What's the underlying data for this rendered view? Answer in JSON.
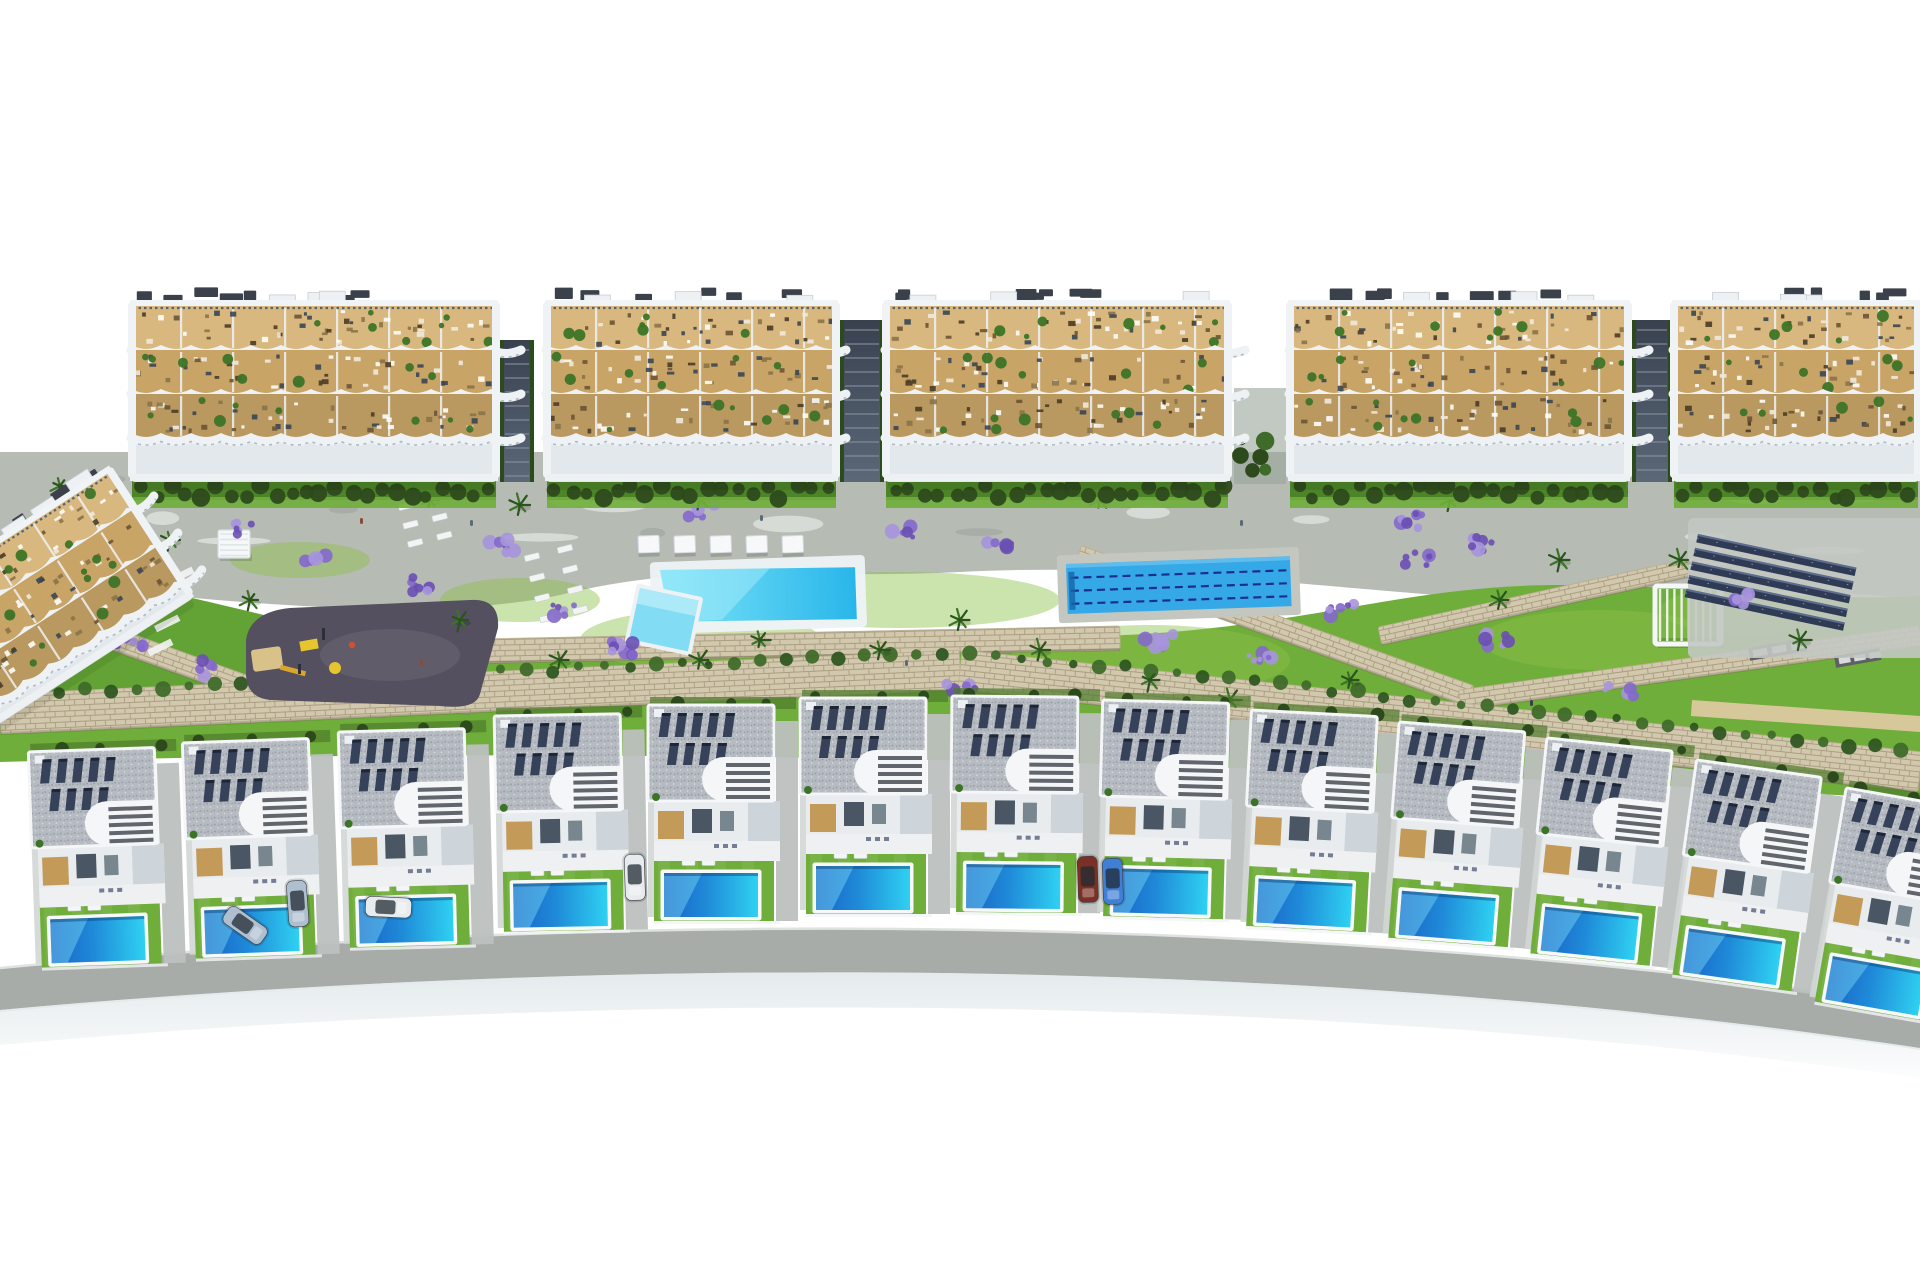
{
  "scene": {
    "description": "aerial-3d-render-residential-resort-complex",
    "canvas": {
      "w": 1920,
      "h": 1280,
      "background": "#ffffff"
    },
    "palette": {
      "white": "#ffffff",
      "concrete": "#b6bbb3",
      "concrete_light": "#e9ece8",
      "path_dark": "#9aa09b",
      "grass": "#6fae3a",
      "grass_light": "#8cc04a",
      "grass_dark": "#4e8f2d",
      "hedge": "#2d4a1c",
      "hedge_mid": "#4c8427",
      "stone": "#d2c8ae",
      "stone_joint": "#ab9e81",
      "lavender": "#8468cc",
      "lavender_light": "#a795dd",
      "lavender_dark": "#6a4fb4",
      "palm": "#3c7427",
      "palm_dark": "#29541b",
      "terrace_tan": "#c9a467",
      "terrace_sand": "#d8b87e",
      "balcony_white": "#eef2f5",
      "railing": "#59636f",
      "roof_unit": "#3a414a",
      "pool_main_1": "#7ce4f8",
      "pool_main_2": "#29b6ea",
      "pool_small": "#82dcf4",
      "lap_pool": "#35a9e8",
      "lane": "#1c2f8e",
      "playground": "#54505f",
      "play_yellow": "#e6c52f",
      "sand": "#d9c28a",
      "solar": "#2f3b55",
      "solar_edge": "#5d6d8e",
      "villa_roof": "#b6bac1",
      "villa_roof_dot": "#949aa5",
      "villa_white": "#f4f6f8",
      "villa_wall_shade": "#cdd5da",
      "wood": "#c49a58",
      "window_dark": "#3a4654",
      "stair": "#474c55",
      "villa_pool_1": "#1a63c8",
      "villa_pool_2": "#2fd1f2",
      "driveway": "#bcc0be",
      "road": "#a7aca8",
      "road_shadow": "#c6d2d8",
      "car_silver": "#aebfd0",
      "car_white": "#e8ebee",
      "car_blue": "#3f7fd6",
      "car_maroon": "#7a3024"
    },
    "apartment_blocks": [
      {
        "x": 130,
        "y": 292,
        "w": 368,
        "h": 190
      },
      {
        "x": 545,
        "y": 292,
        "w": 293,
        "h": 190
      },
      {
        "x": 884,
        "y": 292,
        "w": 346,
        "h": 190
      },
      {
        "x": 1288,
        "y": 292,
        "w": 342,
        "h": 190
      },
      {
        "x": 1672,
        "y": 292,
        "w": 248,
        "h": 190
      }
    ],
    "left_building": {
      "x": -105,
      "y": 595,
      "w": 250,
      "h": 165,
      "rot": -33
    },
    "ramps": [
      {
        "x": 500,
        "y": 340,
        "w": 34,
        "h": 142
      },
      {
        "x": 840,
        "y": 320,
        "w": 44,
        "h": 162
      },
      {
        "x": 1632,
        "y": 320,
        "w": 40,
        "h": 162
      }
    ],
    "gap_garden": {
      "x": 1234,
      "y": 388,
      "w": 52,
      "h": 96
    },
    "garden": {
      "left_pergola": {
        "x": 218,
        "y": 530,
        "w": 32,
        "h": 28
      },
      "left_mini_pool": {
        "x": 28,
        "y": 630,
        "w": 26,
        "h": 18,
        "rot": -33
      },
      "main_pool": {
        "x": 660,
        "y": 570,
        "w": 195,
        "h": 56,
        "rot": -2
      },
      "small_pool": {
        "x": 640,
        "y": 588,
        "w": 60,
        "h": 52,
        "rot": 12
      },
      "lap_pool": {
        "x": 1066,
        "y": 564,
        "w": 224,
        "h": 50,
        "rot": -2
      },
      "cabanas": {
        "x": 638,
        "y": 536,
        "count": 5,
        "step": 36,
        "w": 21,
        "h": 17
      },
      "lounger_groups": [
        {
          "x": 524,
          "y": 556,
          "cols": 2,
          "rows": 4,
          "stepx": 34,
          "stepy": 21,
          "rot": -14
        },
        {
          "x": 398,
          "y": 505,
          "cols": 2,
          "rows": 3,
          "stepx": 30,
          "stepy": 19,
          "rot": -14
        }
      ],
      "playground": {
        "x": 246,
        "y": 600
      },
      "pergola": {
        "x": 1655,
        "y": 586,
        "w": 66,
        "h": 58
      },
      "solar": {
        "x": 1698,
        "y": 534,
        "rows": 5,
        "w": 162,
        "h": 8.5,
        "step": 14,
        "rot": 12
      },
      "mats": [
        {
          "x": 1748,
          "y": 648,
          "w": 58,
          "h": 13,
          "rot": -10
        },
        {
          "x": 1834,
          "y": 656,
          "w": 46,
          "h": 12,
          "rot": -10
        }
      ],
      "beige_path": {
        "x": 1692,
        "y": 700,
        "w": 230,
        "h": 16,
        "rot": 4
      }
    },
    "walls": [
      [
        0,
        598,
        250,
        688,
        22
      ],
      [
        250,
        688,
        470,
        706,
        16
      ],
      [
        430,
        652,
        1120,
        638,
        24
      ],
      [
        1078,
        556,
        1470,
        696,
        22
      ],
      [
        1380,
        636,
        1760,
        552,
        18
      ],
      [
        1460,
        700,
        1920,
        636,
        20
      ],
      [
        0,
        714,
        960,
        670,
        40
      ],
      [
        960,
        670,
        1920,
        772,
        40
      ]
    ],
    "lavender_clusters": [
      [
        60,
        600
      ],
      [
        130,
        640
      ],
      [
        210,
        668
      ],
      [
        320,
        560
      ],
      [
        420,
        585
      ],
      [
        250,
        530
      ],
      [
        500,
        545
      ],
      [
        560,
        610
      ],
      [
        620,
        648
      ],
      [
        900,
        530
      ],
      [
        1000,
        540
      ],
      [
        1160,
        640
      ],
      [
        1260,
        660
      ],
      [
        1340,
        610
      ],
      [
        1420,
        560
      ],
      [
        1500,
        640
      ],
      [
        1620,
        690
      ],
      [
        80,
        520
      ],
      [
        960,
        688
      ],
      [
        1750,
        600
      ],
      [
        1408,
        520
      ],
      [
        1480,
        545
      ],
      [
        700,
        512
      ]
    ],
    "palms": [
      [
        95,
        560
      ],
      [
        170,
        540
      ],
      [
        250,
        600
      ],
      [
        460,
        620
      ],
      [
        560,
        660
      ],
      [
        700,
        660
      ],
      [
        760,
        640
      ],
      [
        880,
        650
      ],
      [
        960,
        620
      ],
      [
        1040,
        650
      ],
      [
        1150,
        680
      ],
      [
        1230,
        700
      ],
      [
        1350,
        680
      ],
      [
        1500,
        600
      ],
      [
        1560,
        560
      ],
      [
        1680,
        560
      ],
      [
        1800,
        640
      ],
      [
        430,
        500
      ],
      [
        520,
        505
      ],
      [
        700,
        498
      ],
      [
        1100,
        500
      ],
      [
        1450,
        500
      ],
      [
        60,
        486
      ],
      [
        350,
        486
      ]
    ],
    "grass_patches": [
      [
        700,
        640,
        120,
        30
      ],
      [
        1150,
        660,
        140,
        35
      ],
      [
        520,
        600,
        80,
        22
      ],
      [
        1600,
        640,
        120,
        30
      ],
      [
        300,
        560,
        70,
        18
      ],
      [
        900,
        600,
        160,
        28
      ],
      [
        1750,
        610,
        90,
        24
      ]
    ],
    "villas": [
      [
        28,
        742,
        -2
      ],
      [
        182,
        733,
        -2
      ],
      [
        338,
        722,
        -1.5
      ],
      [
        494,
        706,
        -1
      ],
      [
        648,
        695,
        0
      ],
      [
        800,
        688,
        0
      ],
      [
        952,
        686,
        0.5
      ],
      [
        1103,
        690,
        1.5
      ],
      [
        1252,
        700,
        3
      ],
      [
        1400,
        712,
        4.5
      ],
      [
        1548,
        728,
        6
      ],
      [
        1698,
        750,
        8
      ],
      [
        1848,
        778,
        10
      ]
    ],
    "cars": [
      [
        232,
        904,
        35,
        "car_silver"
      ],
      [
        306,
        880,
        86,
        "car_silver"
      ],
      [
        366,
        896,
        3,
        "car_white"
      ],
      [
        644,
        854,
        88,
        "car_white"
      ],
      [
        1097,
        856,
        88,
        "car_maroon"
      ],
      [
        1122,
        858,
        88,
        "car_blue"
      ]
    ],
    "people_specks": [
      [
        470,
        520
      ],
      [
        760,
        515
      ],
      [
        905,
        660
      ],
      [
        1240,
        520
      ],
      [
        1530,
        700
      ],
      [
        420,
        660
      ],
      [
        1180,
        460
      ],
      [
        360,
        518
      ]
    ],
    "road": {
      "top": "M0,968 C550,915 1250,905 1920,1005",
      "band": "M0,968 C550,915 1250,905 1920,1005 L1920,1048 C1250,948 550,960 0,1010 Z",
      "shadow": "M0,1010 C550,960 1250,948 1920,1048 L1920,1078 C1250,985 550,995 0,1045 Z",
      "fade": "M0,1012 C550,962 1250,950 1920,1050 L1920,1280 L0,1280 Z"
    }
  }
}
